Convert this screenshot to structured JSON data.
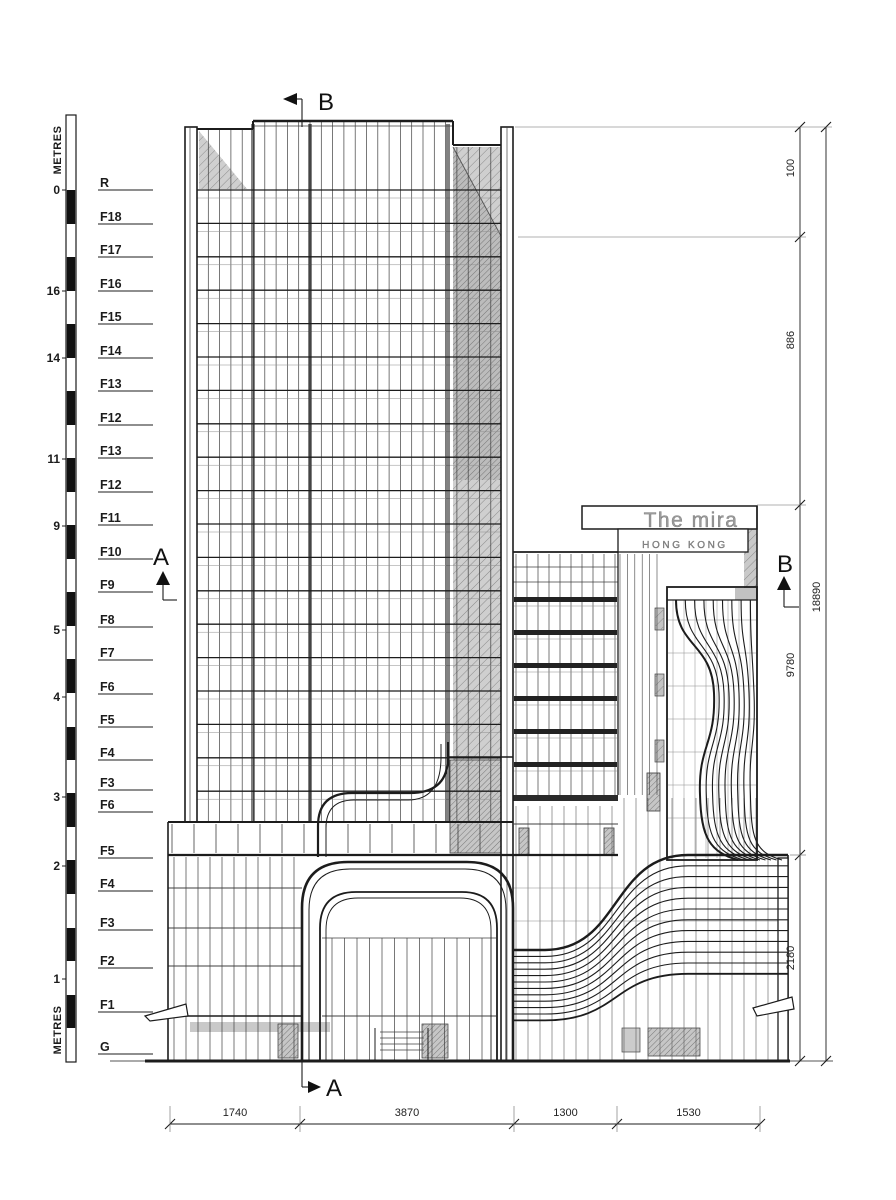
{
  "sign": {
    "title": "The mira",
    "subtitle": "HONG KONG"
  },
  "markers": {
    "top": "B",
    "right": "B",
    "left": "A",
    "bottom": "A"
  },
  "scale_bar": {
    "unit_top": "METRES",
    "unit_bottom": "METRES",
    "ticks": [
      "0",
      "16",
      "14",
      "11",
      "9",
      "5",
      "4",
      "3",
      "2",
      "1"
    ]
  },
  "floor_labels": [
    "R",
    "F18",
    "F17",
    "F16",
    "F15",
    "F14",
    "F13",
    "F12",
    "F13",
    "F12",
    "F11",
    "F10",
    "F9",
    "F8",
    "F7",
    "F6",
    "F5",
    "F4",
    "F3",
    "F6",
    "F5",
    "F4",
    "F3",
    "F2",
    "F1",
    "G"
  ],
  "dimensions": {
    "right_inner": [
      "100",
      "886",
      "9780",
      "2180"
    ],
    "right_outer": "18890",
    "bottom": [
      "1740",
      "3870",
      "1300",
      "1530"
    ]
  },
  "colors": {
    "ink": "#1c1c1c",
    "grid": "#3f3f3f",
    "light_grid": "#8c8c8c",
    "shade": "#cfcfcf",
    "shade_dark": "#bcbcbc"
  }
}
